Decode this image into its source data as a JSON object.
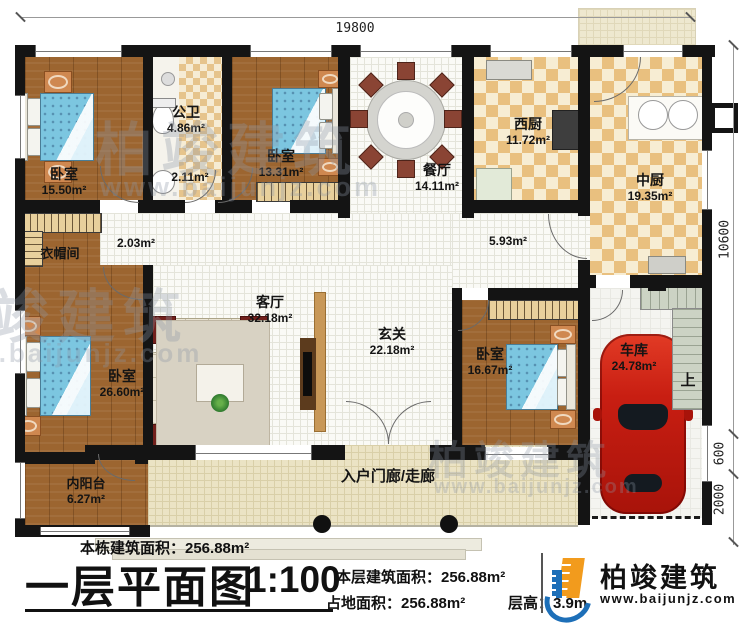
{
  "plan": {
    "dim_top": "19800",
    "dim_right_main": "10600",
    "dim_right_mid": "600",
    "dim_right_bottom": "2000",
    "stairs_up_label": "上"
  },
  "rooms": {
    "bedroom_tl": {
      "name": "卧室",
      "area": "15.50m²"
    },
    "bathroom": {
      "name": "公卫",
      "area": "4.86m²"
    },
    "bath_sink": {
      "area": "2.11m²"
    },
    "bedroom_tm": {
      "name": "卧室",
      "area": "13.31m²"
    },
    "dining": {
      "name": "餐厅",
      "area": "14.11m²"
    },
    "west_kitchen": {
      "name": "西厨",
      "area": "11.72m²"
    },
    "main_kitchen": {
      "name": "中厨",
      "area": "19.35m²"
    },
    "hall_west": {
      "area": "2.03m²"
    },
    "hall_east": {
      "area": "5.93m²"
    },
    "cloakroom": {
      "name": "衣帽间"
    },
    "living": {
      "name": "客厅",
      "area": "32.18m²"
    },
    "foyer": {
      "name": "玄关",
      "area": "22.18m²"
    },
    "bedroom_bl": {
      "name": "卧室",
      "area": "26.60m²"
    },
    "bedroom_br": {
      "name": "卧室",
      "area": "16.67m²"
    },
    "garage": {
      "name": "车库",
      "area": "24.78m²"
    },
    "inner_balcony": {
      "name": "内阳台",
      "area": "6.27m²"
    },
    "porch": {
      "name": "入户门廊/走廊"
    }
  },
  "footer": {
    "building_total_area": "本栋建筑面积：256.88m²",
    "plan_name": "一层平面图",
    "scale": "1:100",
    "floor_area": "本层建筑面积：256.88m²",
    "land_area": "占地面积：256.88m²",
    "floor_height": "层高：3.9m"
  },
  "branding": {
    "company": "柏竣建筑",
    "website": "www.baijunjz.com"
  },
  "watermark": {
    "text": "柏竣建筑",
    "url": "www.baijunjz.com"
  },
  "colors": {
    "wall": "#141414",
    "brand_blue": "#1d6fb8",
    "brand_orange": "#f29b1d",
    "car_red": "#c81e12"
  }
}
